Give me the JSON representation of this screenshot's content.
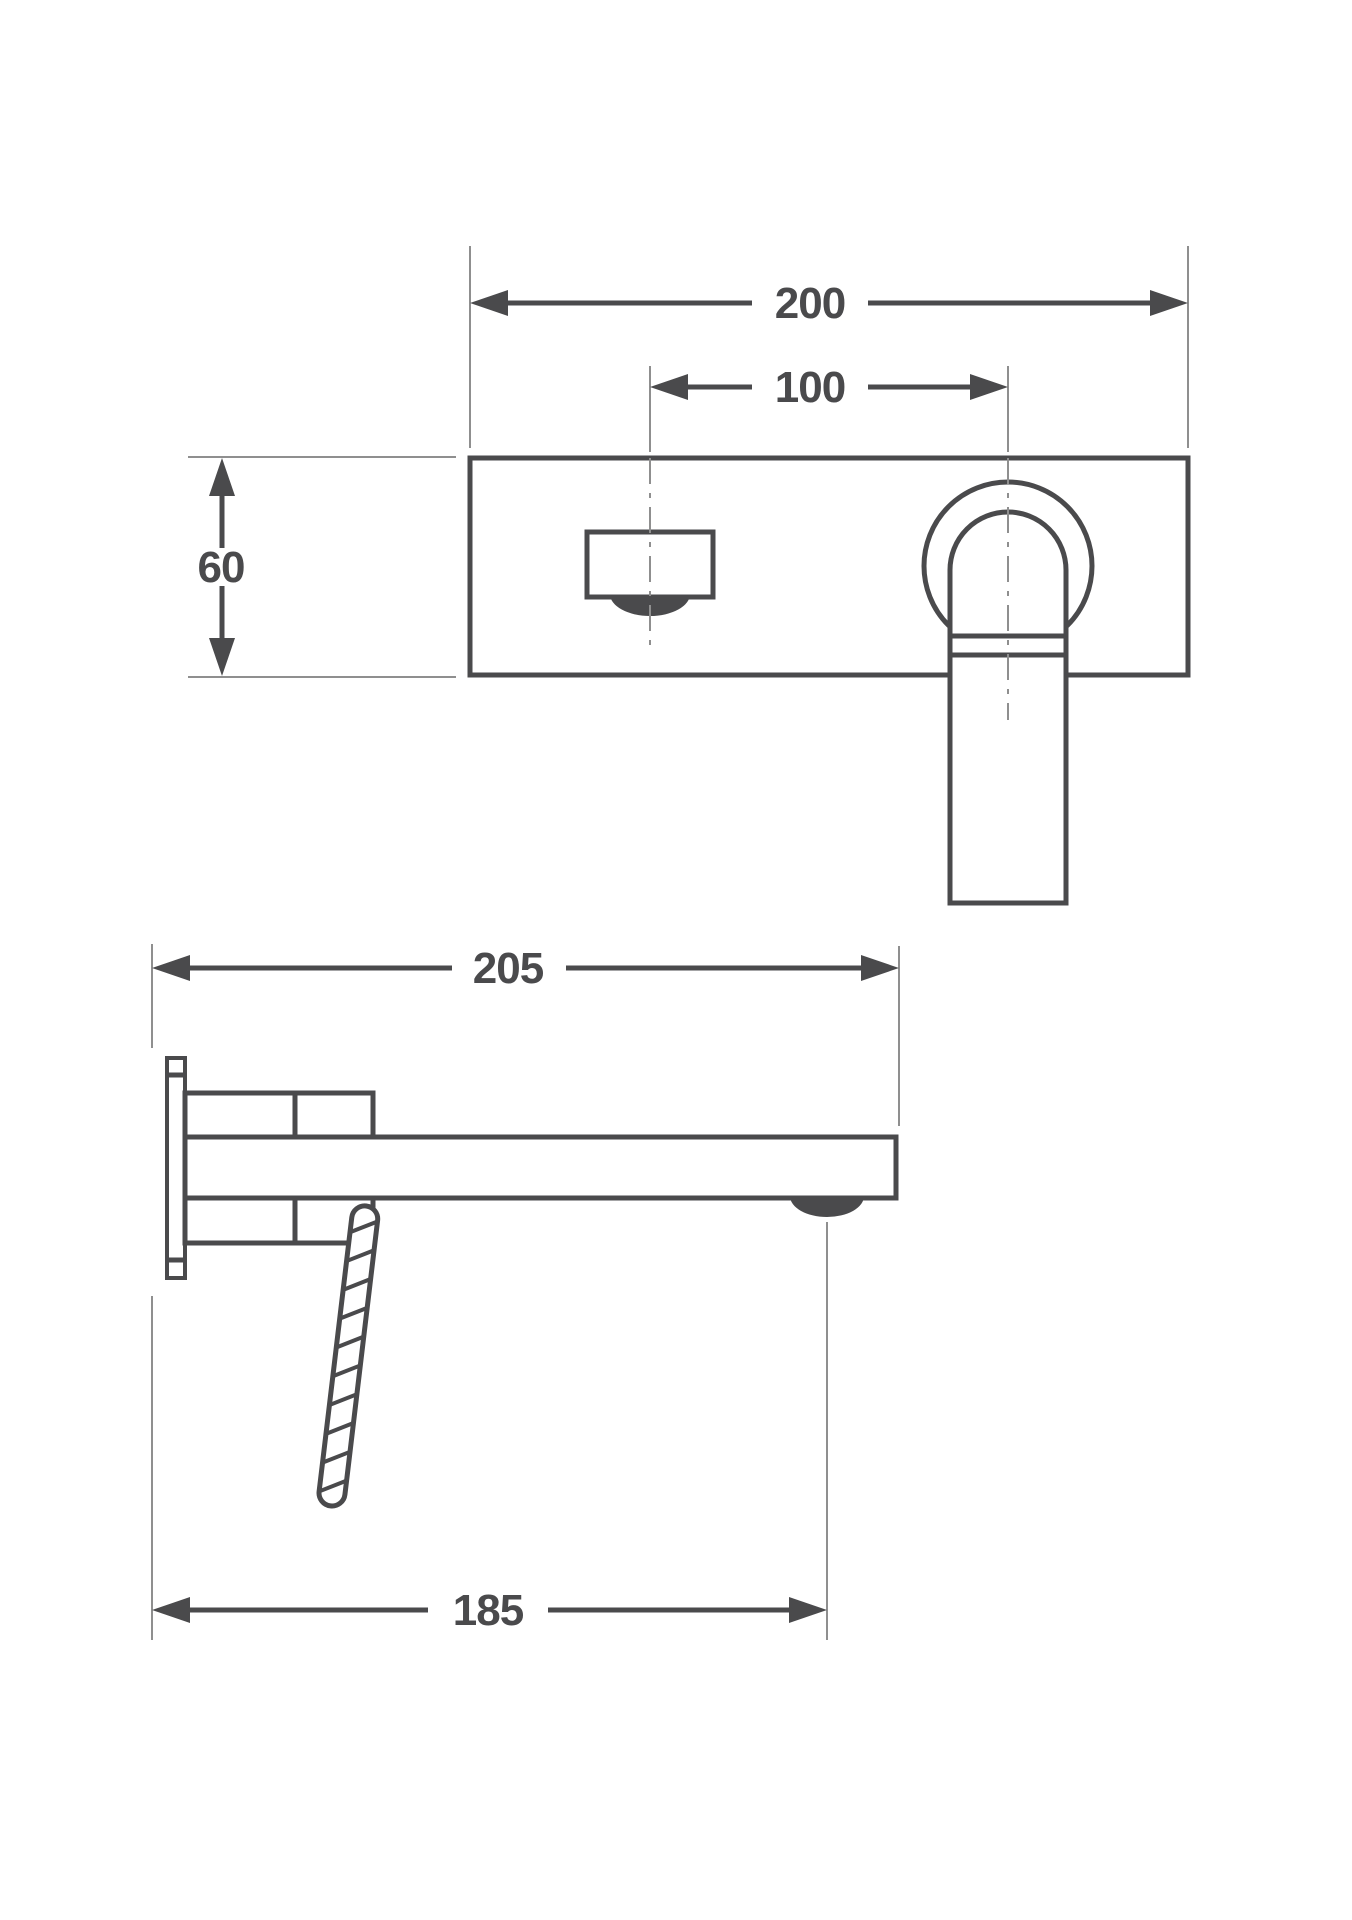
{
  "drawing": {
    "type": "technical-dimension-drawing",
    "subject": "wall-mounted single-lever basin mixer, front view and side view",
    "front_view": {
      "overall_width_mm": "200",
      "spout_to_handle_spacing_mm": "100",
      "plate_height_mm": "60"
    },
    "side_view": {
      "spout_projection_mm": "205",
      "aerator_projection_mm": "185"
    }
  },
  "colors": {
    "outline": "#4a4a4c",
    "dimension": "#4a4a4c",
    "thin_line": "#8f8f8f",
    "background": "#ffffff"
  }
}
